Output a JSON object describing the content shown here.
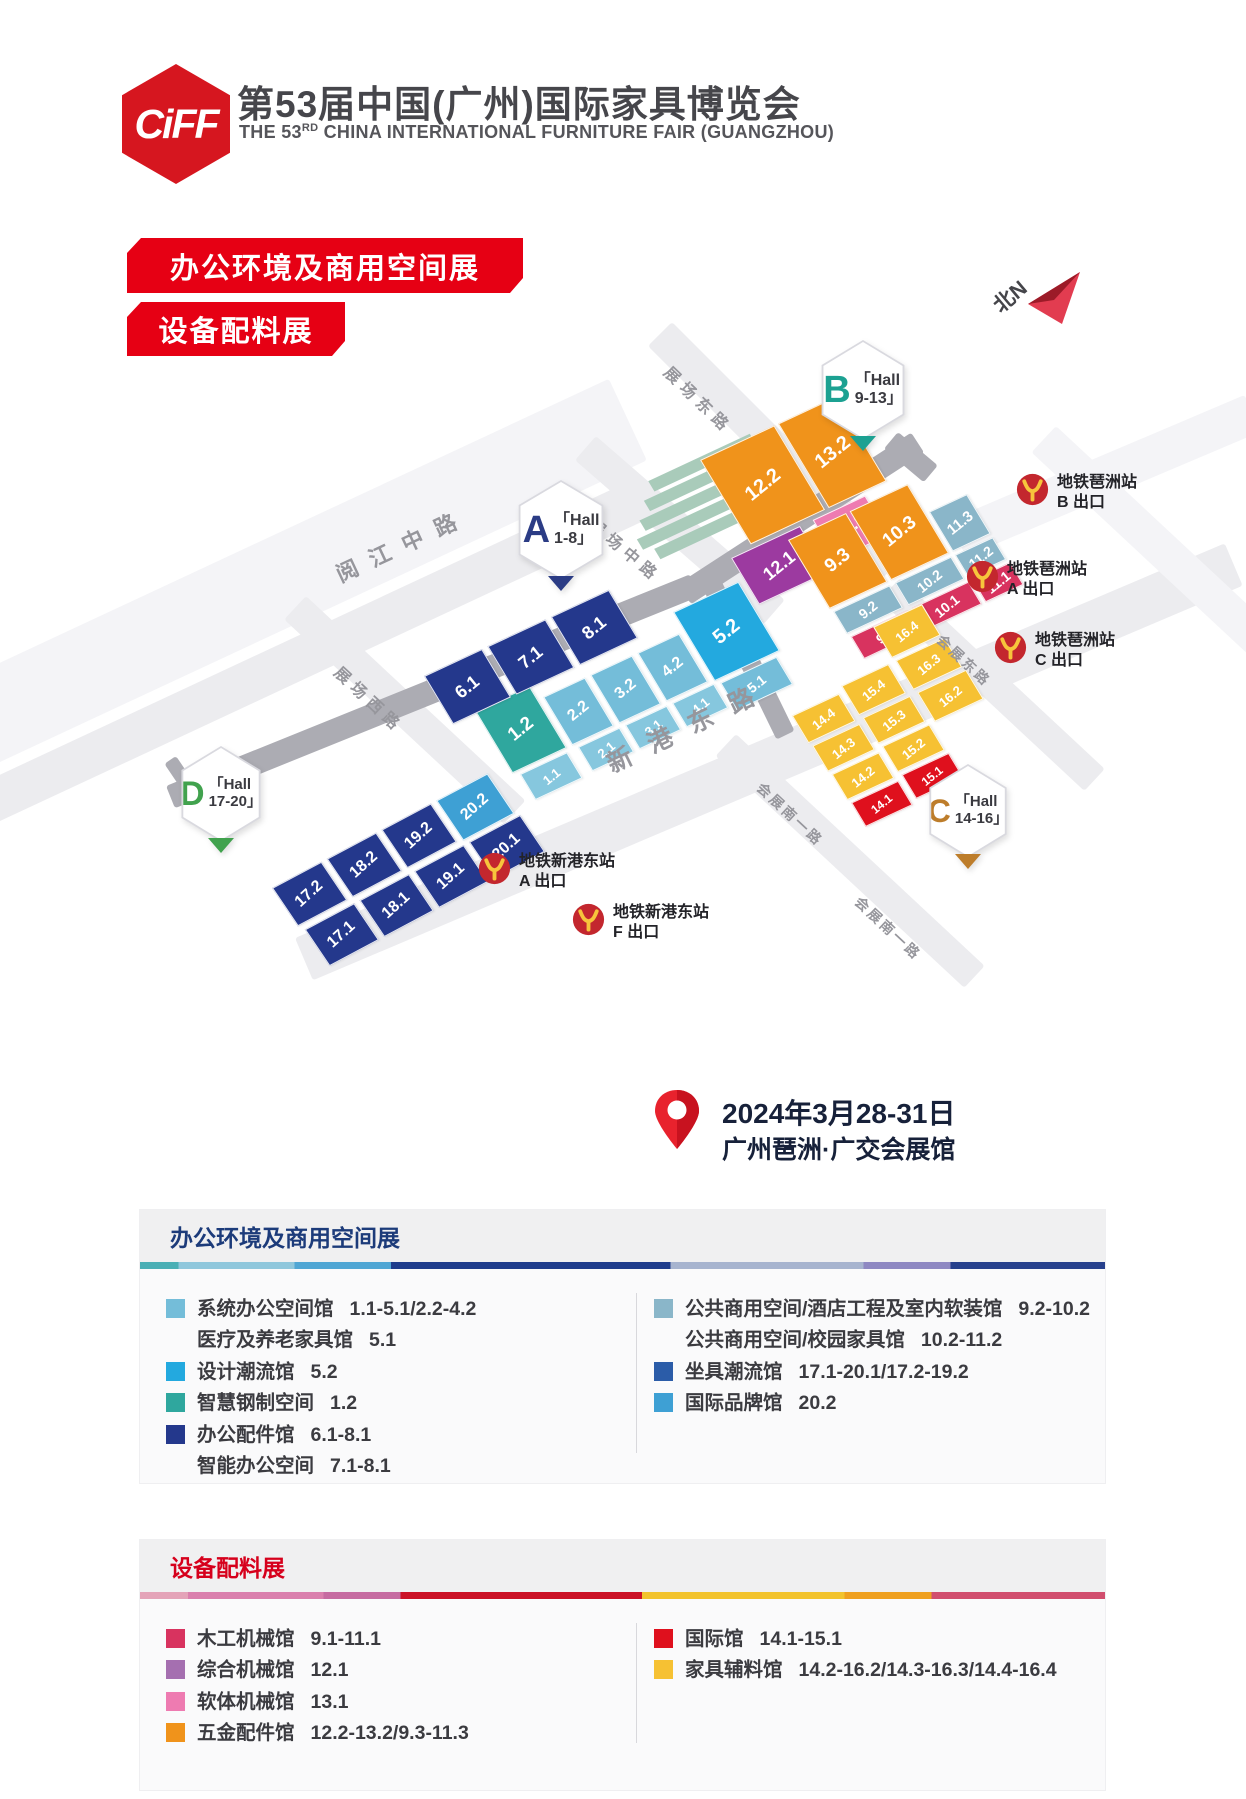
{
  "header": {
    "logo_text": "CiFF",
    "title": "第53届中国(广州)国际家具博览会",
    "subtitle_pre": "THE 53",
    "subtitle_sup": "RD",
    "subtitle_post": " CHINA INTERNATIONAL FURNITURE FAIR (GUANGZHOU)"
  },
  "banners": {
    "banner1": "办公环境及商用空间展",
    "banner2": "设备配料展"
  },
  "compass_label": "北N",
  "event": {
    "date": "2024年3月28-31日",
    "venue": "广州琶洲·广交会展馆"
  },
  "colors": {
    "brand_red": "#E60014",
    "logo_red": "#D6161F",
    "navy": "#24388C",
    "skyblue": "#3EA0D4",
    "lightblue": "#74BDD9",
    "paleblue": "#86C7DE",
    "cyan": "#23A9DF",
    "tealgreen": "#2FA79E",
    "orange": "#F0931B",
    "purple_block": "#9C3AA0",
    "purple": "#A56FB0",
    "pink": "#EE7BB1",
    "steel": "#8AB6C9",
    "crimson": "#D8335F",
    "red": "#DF101D",
    "yellow": "#F6C133",
    "blue": "#2B5CA8",
    "hall_a": "#2B3C85",
    "hall_b": "#1CA192",
    "hall_c": "#BD7D2B",
    "hall_d": "#41A24E",
    "road": "#ECECEF",
    "road_faint": "#F4F4F7",
    "road_dark": "#ACACB3",
    "sage": "#A9CBBA",
    "metro_red": "#C3272E",
    "metro_yellow": "#F7C53C",
    "compass_bright": "#E23C50",
    "compass_dark": "#9C1B28",
    "legend1_title": "#1C3B7A",
    "legend2_title": "#D6001C"
  },
  "map": {
    "road_labels": [
      {
        "text": "阅江中路"
      },
      {
        "text": "展场西路"
      },
      {
        "text": "展场中路"
      },
      {
        "text": "展场东路"
      },
      {
        "text": "新港东路"
      },
      {
        "text": "会展东路"
      },
      {
        "text": "会展南一路"
      },
      {
        "text": "会展南一路"
      }
    ],
    "hall_markers": [
      {
        "letter": "A",
        "line1": "「Hall",
        "line2": "1-8」",
        "color_key": "hall_a"
      },
      {
        "letter": "B",
        "line1": "「Hall",
        "line2": "9-13」",
        "color_key": "hall_b"
      },
      {
        "letter": "C",
        "line1": "「Hall",
        "line2": "14-16」",
        "color_key": "hall_c"
      },
      {
        "letter": "D",
        "line1": "「Hall",
        "line2": "17-20」",
        "color_key": "hall_d"
      }
    ],
    "metro_exits": [
      {
        "station": "地铁琶洲站",
        "exit": "B 出口"
      },
      {
        "station": "地铁琶洲站",
        "exit": "A 出口"
      },
      {
        "station": "地铁琶洲站",
        "exit": "C 出口"
      },
      {
        "station": "地铁新港东站",
        "exit": "A 出口"
      },
      {
        "station": "地铁新港东站",
        "exit": "F 出口"
      }
    ],
    "clusters": {
      "a15": [
        {
          "label": "1.2",
          "type": "tealgreen"
        },
        {
          "label": "2.2",
          "type": "lightblue"
        },
        {
          "label": "3.2",
          "type": "lightblue"
        },
        {
          "label": "4.2",
          "type": "lightblue"
        },
        {
          "label": "5.2",
          "type": "cyan"
        },
        {
          "label": "1.1",
          "type": "paleblue"
        },
        {
          "label": "2.1",
          "type": "paleblue"
        },
        {
          "label": "3.1",
          "type": "paleblue"
        },
        {
          "label": "4.1",
          "type": "paleblue"
        },
        {
          "label": "5.1",
          "type": "lightblue"
        }
      ],
      "a68": [
        {
          "label": "6.1",
          "type": "navy"
        },
        {
          "label": "7.1",
          "type": "navy"
        },
        {
          "label": "8.1",
          "type": "navy"
        }
      ],
      "d": [
        {
          "label": "17.2",
          "type": "navy"
        },
        {
          "label": "18.2",
          "type": "navy"
        },
        {
          "label": "19.2",
          "type": "navy"
        },
        {
          "label": "20.2",
          "type": "skyblue"
        },
        {
          "label": "17.1",
          "type": "navy"
        },
        {
          "label": "18.1",
          "type": "navy"
        },
        {
          "label": "19.1",
          "type": "navy"
        },
        {
          "label": "20.1",
          "type": "navy"
        }
      ],
      "b1213": [
        {
          "label": "12.2",
          "type": "orange"
        },
        {
          "label": "13.2",
          "type": "orange"
        },
        {
          "label": "12.1",
          "type": "purple_block"
        },
        {
          "label": "13.1",
          "type": "pink"
        }
      ],
      "b91011": [
        {
          "label": "9.3",
          "type": "orange"
        },
        {
          "label": "10.3",
          "type": "orange"
        },
        {
          "label": "11.3",
          "type": "steel"
        },
        {
          "label": "9.2",
          "type": "steel"
        },
        {
          "label": "10.2",
          "type": "steel"
        },
        {
          "label": "11.2",
          "type": "steel"
        },
        {
          "label": "9.1",
          "type": "crimson"
        },
        {
          "label": "10.1",
          "type": "crimson"
        },
        {
          "label": "11.1",
          "type": "crimson"
        }
      ],
      "c1416": [
        {
          "label": "16.4",
          "type": "yellow"
        },
        {
          "label": "16.3",
          "type": "yellow"
        },
        {
          "label": "16.2",
          "type": "yellow"
        },
        {
          "label": "15.4",
          "type": "yellow"
        },
        {
          "label": "15.3",
          "type": "yellow"
        },
        {
          "label": "15.2",
          "type": "yellow"
        },
        {
          "label": "15.1",
          "type": "red"
        },
        {
          "label": "14.4",
          "type": "yellow"
        },
        {
          "label": "14.3",
          "type": "yellow"
        },
        {
          "label": "14.2",
          "type": "yellow"
        },
        {
          "label": "14.1",
          "type": "red"
        }
      ]
    }
  },
  "legends": [
    {
      "title": "办公环境及商用空间展",
      "columns": [
        [
          {
            "color": "lightblue",
            "name": "系统办公空间馆",
            "range": "1.1-5.1/2.2-4.2"
          },
          {
            "color": null,
            "name": "医疗及养老家具馆",
            "range": "5.1"
          },
          {
            "color": "cyan",
            "name": "设计潮流馆",
            "range": "5.2"
          },
          {
            "color": "tealgreen",
            "name": "智慧钢制空间",
            "range": "1.2"
          },
          {
            "color": "navy",
            "name": "办公配件馆",
            "range": "6.1-8.1"
          },
          {
            "color": null,
            "name": "智能办公空间",
            "range": "7.1-8.1"
          }
        ],
        [
          {
            "color": "steel",
            "name": "公共商用空间/酒店工程及室内软装馆",
            "range": "9.2-10.2"
          },
          {
            "color": null,
            "name": "公共商用空间/校园家具馆",
            "range": "10.2-11.2"
          },
          {
            "color": "blue",
            "name": "坐具潮流馆",
            "range": "17.1-20.1/17.2-19.2"
          },
          {
            "color": "skyblue",
            "name": "国际品牌馆",
            "range": "20.2"
          }
        ]
      ]
    },
    {
      "title": "设备配料展",
      "columns": [
        [
          {
            "color": "crimson",
            "name": "木工机械馆",
            "range": "9.1-11.1"
          },
          {
            "color": "purple",
            "name": "综合机械馆",
            "range": "12.1"
          },
          {
            "color": "pink",
            "name": "软体机械馆",
            "range": "13.1"
          },
          {
            "color": "orange",
            "name": "五金配件馆",
            "range": "12.2-13.2/9.3-11.3"
          }
        ],
        [
          {
            "color": "red",
            "name": "国际馆",
            "range": "14.1-15.1"
          },
          {
            "color": "yellow",
            "name": "家具辅料馆",
            "range": "14.2-16.2/14.3-16.3/14.4-16.4"
          }
        ]
      ]
    }
  ]
}
